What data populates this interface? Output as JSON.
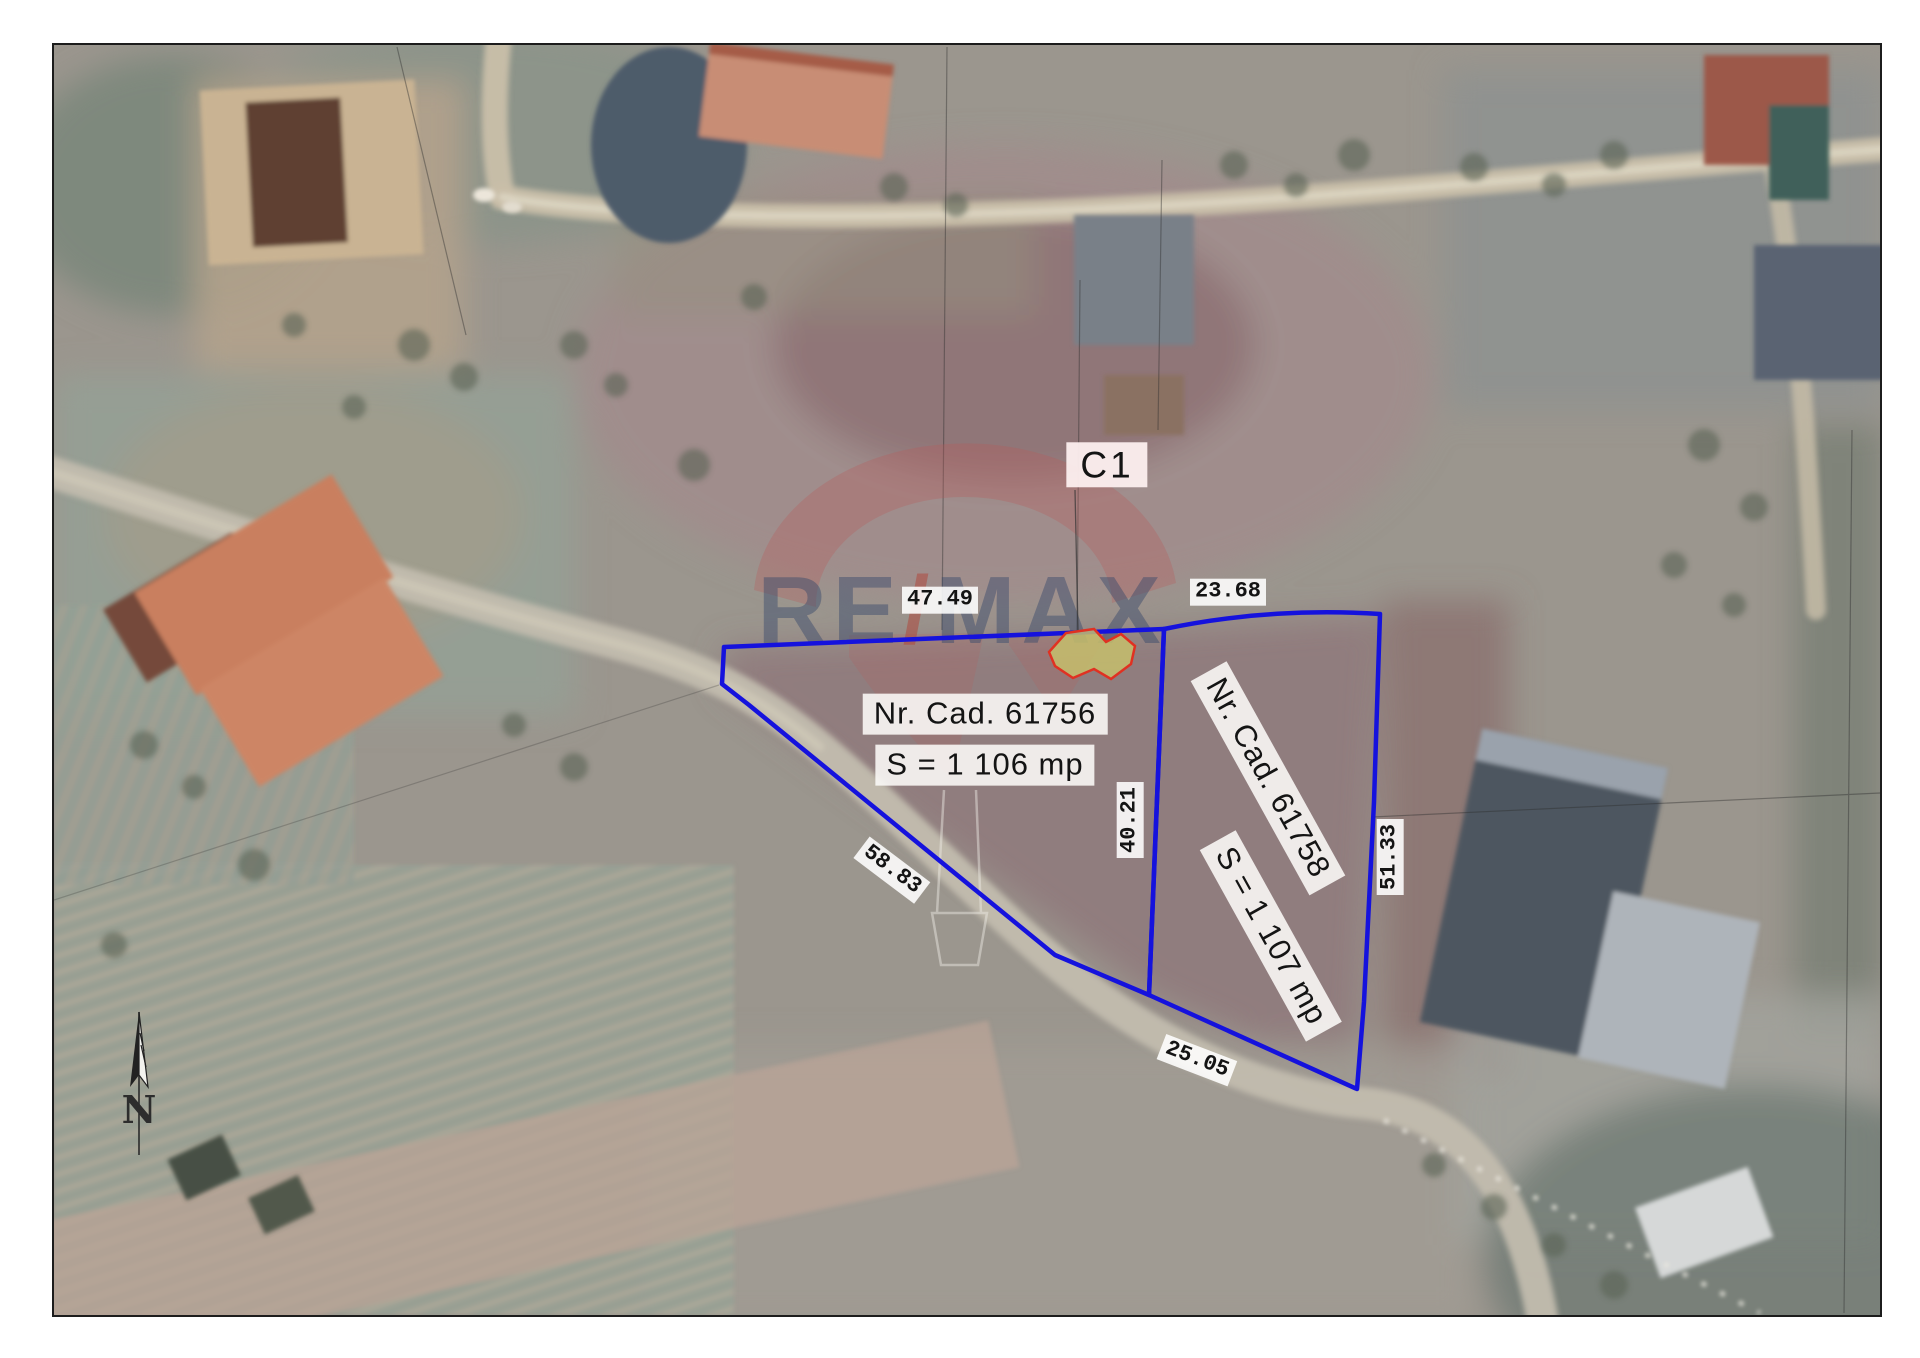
{
  "watermark": {
    "full": "RE/MAX",
    "re": "RE",
    "slash": "/",
    "max": "MAX"
  },
  "compass": {
    "north": "N"
  },
  "construction": {
    "label": "C1"
  },
  "plots": [
    {
      "id": "61756",
      "cad": "Nr. Cad. 61756",
      "area": "S = 1 106 mp"
    },
    {
      "id": "61758",
      "cad": "Nr. Cad. 61758",
      "area": "S = 1 107 mp"
    }
  ],
  "dimensions": {
    "top_plot1": "47.49",
    "top_plot2": "23.68",
    "west": "58.83",
    "divider": "40.21",
    "east": "51.33",
    "south": "25.05"
  },
  "colors": {
    "boundary_blue": "#1512dd",
    "building_fill": "#c5be6c",
    "building_stroke": "#e03122",
    "label_bg": "#ffffff",
    "c1_label_bg": "#fbeded",
    "watermark_red": "#b85a5a",
    "watermark_navy": "#36476b"
  }
}
